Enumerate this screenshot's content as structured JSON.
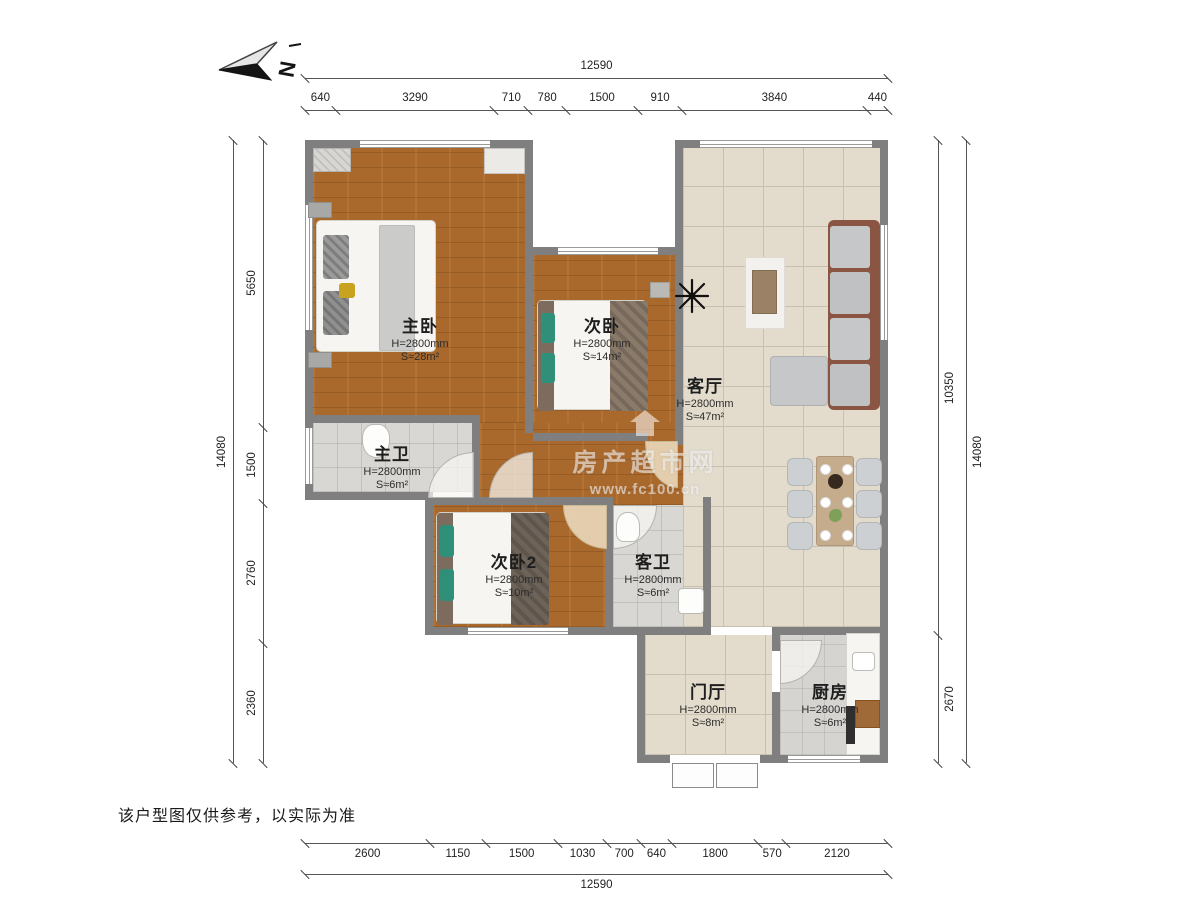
{
  "compass": {
    "label": "N"
  },
  "disclaimer": "该户型图仅供参考，以实际为准",
  "watermark": {
    "brand": "房产超市网",
    "url": "www.fc100.cn"
  },
  "rooms": [
    {
      "name": "主卧",
      "height": "H=2800mm",
      "area": "S≈28m²"
    },
    {
      "name": "次卧",
      "height": "H=2800mm",
      "area": "S≈14m²"
    },
    {
      "name": "客厅",
      "height": "H=2800mm",
      "area": "S≈47m²"
    },
    {
      "name": "主卫",
      "height": "H=2800mm",
      "area": "S≈6m²"
    },
    {
      "name": "次卧2",
      "height": "H=2800mm",
      "area": "S≈10m²"
    },
    {
      "name": "客卫",
      "height": "H=2800mm",
      "area": "S≈6m²"
    },
    {
      "name": "门厅",
      "height": "H=2800mm",
      "area": "S≈8m²"
    },
    {
      "name": "厨房",
      "height": "H=2800mm",
      "area": "S≈6m²"
    }
  ],
  "dimensions": {
    "top": {
      "total": "12590",
      "segments": [
        "640",
        "3290",
        "710",
        "780",
        "1500",
        "910",
        "3840",
        "440"
      ]
    },
    "bottom": {
      "total": "12590",
      "segments": [
        "2600",
        "1150",
        "1500",
        "1030",
        "700",
        "640",
        "1800",
        "570",
        "2120"
      ]
    },
    "left": {
      "total": "14080",
      "segments": [
        "5650",
        "1500",
        "2760",
        "2360"
      ]
    },
    "right": {
      "total": "14080",
      "segments": [
        "10350",
        "2670"
      ]
    }
  },
  "colors": {
    "wall": "#7f7f7f",
    "wood": "#aa692c",
    "tile": "#e3dccd",
    "bath": "#d8d7d3",
    "accent_teal": "#2f8f78",
    "sofa_frame": "#8a5643",
    "table_wood": "#c5ac8c"
  }
}
